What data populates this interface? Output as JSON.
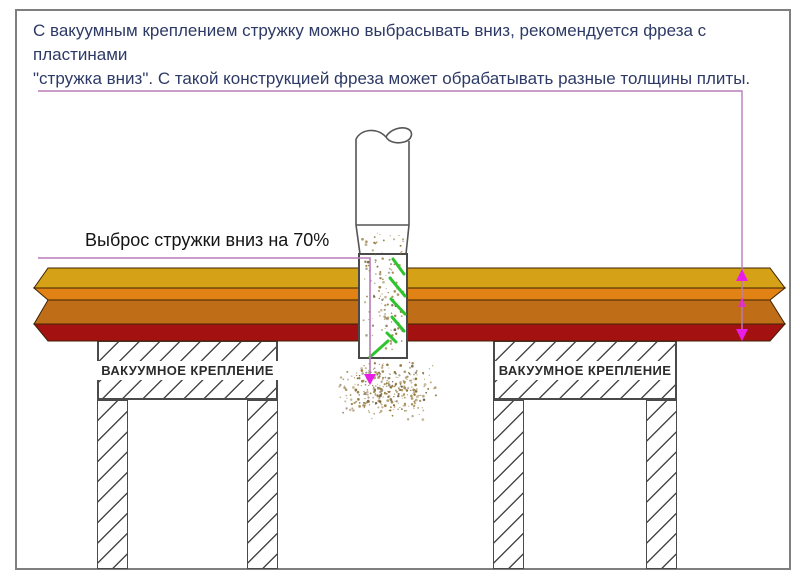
{
  "intro": {
    "lines": [
      "С вакуумным креплением стружку можно выбрасывать вниз, рекомендуется фреза с пластинами",
      "\"стружка вниз\". С такой конструкцией фреза может обрабатывать разные толщины плиты."
    ]
  },
  "labels": {
    "chip_down": "Выброс стружки вниз на 70%",
    "vacuum_clamp_left": "ВАКУУМНОЕ КРЕПЛЕНИЕ",
    "vacuum_clamp_right": "ВАКУУМНОЕ КРЕПЛЕНИЕ"
  },
  "colors": {
    "intro_text": "#2E3A66",
    "frame_border": "#7f7f7f",
    "layer_top": "#D4A117",
    "layer_second": "#E08214",
    "layer_core": "#C06D18",
    "layer_bottom": "#A31111",
    "layer_edge": "#3d2303",
    "leader_line": "#B97CB9",
    "measure_line": "#B97CB9",
    "arrow": "#E81EE8",
    "insert_green": "#2EC42E",
    "chips": "#8F7436",
    "cutter_outline": "#4a4a4a"
  }
}
